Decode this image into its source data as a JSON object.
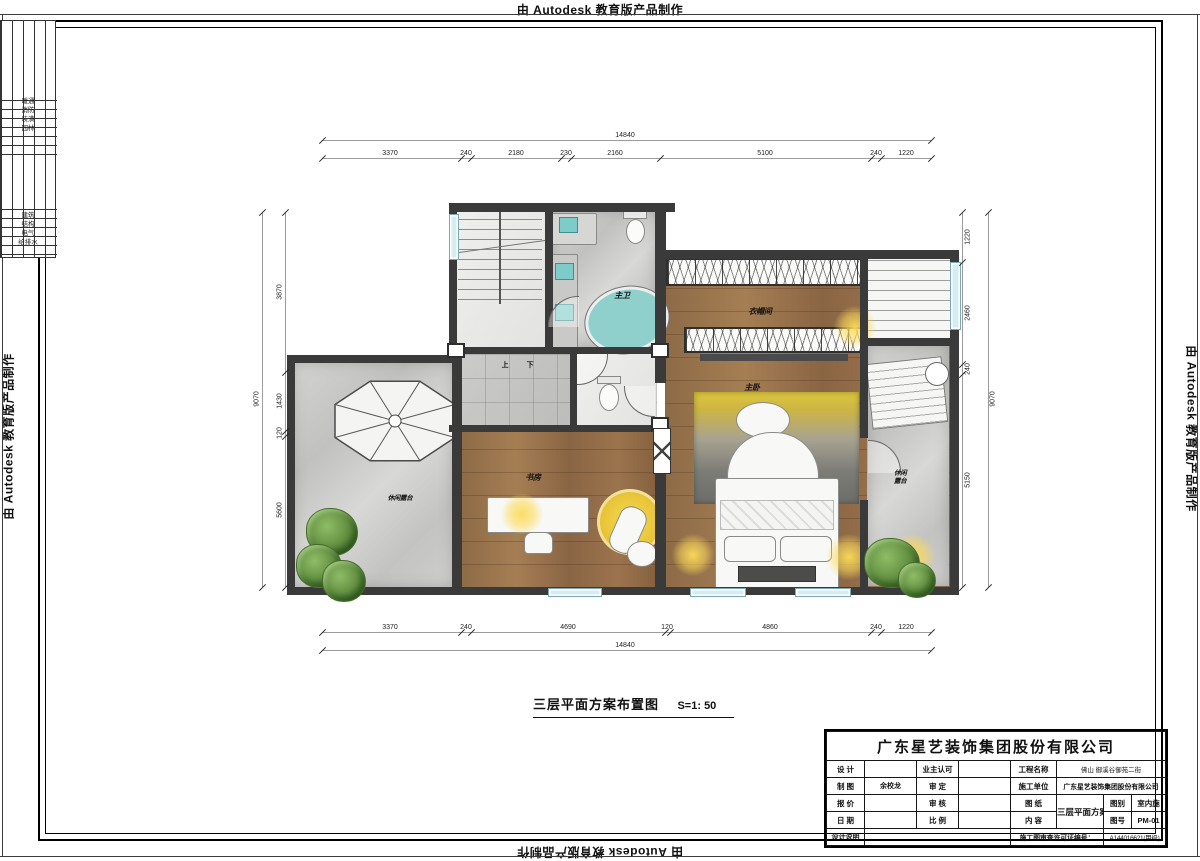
{
  "watermark": "由 Autodesk 教育版产品制作",
  "disc": {
    "g1": [
      "暖通",
      "消防",
      "装潢",
      "园林"
    ],
    "g2": [
      "建筑",
      "结构",
      "电气",
      "给排水"
    ]
  },
  "plan": {
    "title": "三层平面方案布置图",
    "scale": "S=1: 50",
    "labels": {
      "bath": "主卫",
      "closet": "衣帽间",
      "bedroom": "主卧",
      "study": "书房",
      "terrace_left": "休闲露台",
      "terrace_right": "休闲露台",
      "stair_up": "上",
      "stair_down": "下"
    }
  },
  "dims": {
    "top": {
      "total": "14840",
      "segs": [
        "3370",
        "240",
        "2180",
        "230",
        "2160",
        "5100",
        "240",
        "1220"
      ]
    },
    "bottom": {
      "total": "14840",
      "segs": [
        "3370",
        "240",
        "4690",
        "120",
        "4860",
        "240",
        "1220"
      ]
    },
    "left": {
      "total": "9070",
      "segs": [
        "3870",
        "1430",
        "120",
        "5600"
      ]
    },
    "right": {
      "total": "9070",
      "segs": [
        "1220",
        "2460",
        "240",
        "5150"
      ]
    }
  },
  "tb": {
    "company": "广东星艺装饰集团股份有限公司",
    "design": "设 计",
    "owner": "业主认可",
    "proj": "工程名称",
    "proj_v": "佛山 御溪谷御苑二街",
    "draft": "制 图",
    "draft_v": "余校龙",
    "approve": "审 定",
    "builder": "施工单位",
    "builder_v": "广东星艺装饰集团股份有限公司",
    "quote": "报 价",
    "check": "审 核",
    "paper": "图 纸",
    "content": "内 容",
    "sheet": "三层平面方案布置图",
    "cat": "图别",
    "cat_v": "室内施",
    "num": "图号",
    "num_v": "PM-01",
    "date": "日 期",
    "ratio": "比 例",
    "notes": "设计说明",
    "permit": "施工图审查许可证编号：",
    "permit_v": "A144016621(甲级)"
  }
}
